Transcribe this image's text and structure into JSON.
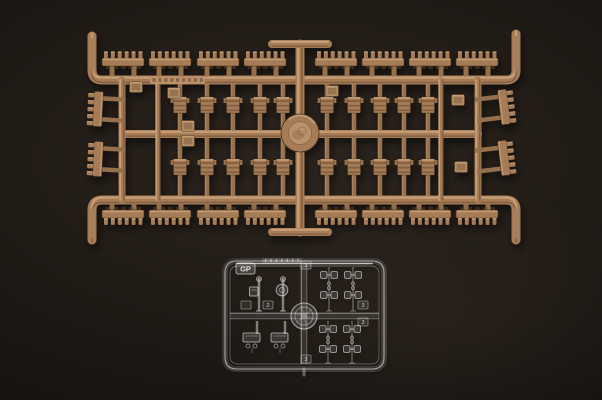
{
  "meta": {
    "description": "Photograph of two injection-molded model kit sprues on a black background: a large tan sprue of tank track links and small parts, and a small clear sprue of periscopes and lenses marked GP"
  },
  "background": {
    "center": "#2b241e",
    "mid": "#211b16",
    "edge": "#0c0a09"
  },
  "tan_sprue": {
    "label": "tan track-link sprue",
    "colors": {
      "base": "#a67c57",
      "base2": "#94704e",
      "light": "#cba57b",
      "dark": "#5e4029",
      "line": "#46301f",
      "tag": "#b08a61",
      "strip": "#bb9169",
      "hub_in": "#b9916b"
    },
    "top_rail": {
      "x1": 96,
      "x2": 512,
      "y": 80,
      "hook_y": 36,
      "w": 9
    },
    "bottom_rail": {
      "x1": 96,
      "x2": 512,
      "y": 200,
      "hook_y": 240,
      "w": 9
    },
    "mid_rail": {
      "x1": 124,
      "x2": 478,
      "y": 134,
      "w": 8
    },
    "v_rails": [
      {
        "x": 122,
        "y1": 80,
        "y2": 200,
        "w": 7
      },
      {
        "x": 158,
        "y1": 80,
        "y2": 200,
        "w": 5
      },
      {
        "x": 300,
        "y1": 44,
        "y2": 232,
        "w": 9
      },
      {
        "x": 441,
        "y1": 80,
        "y2": 200,
        "w": 5
      },
      {
        "x": 478,
        "y1": 80,
        "y2": 200,
        "w": 7
      }
    ],
    "t_bars": [
      {
        "x1": 272,
        "x2": 328,
        "y": 44,
        "w": 8
      },
      {
        "x1": 272,
        "x2": 328,
        "y": 232,
        "w": 8
      }
    ],
    "hub": {
      "cx": 300,
      "cy": 133,
      "r": 19
    },
    "text_strip": {
      "x": 150,
      "y": 76,
      "w": 55,
      "h": 8
    },
    "track_row_top": {
      "y": 62,
      "xs": [
        123,
        170,
        218,
        265,
        336,
        383,
        430,
        477
      ],
      "teeth": 6
    },
    "track_row_bottom": {
      "y": 214,
      "xs": [
        123,
        170,
        218,
        265,
        336,
        383,
        430,
        477
      ],
      "teeth": 6
    },
    "pin_rows": [
      {
        "y1": 84.5,
        "y2": 130.5,
        "cy": 105,
        "xs": [
          180,
          207,
          233,
          260,
          283,
          327,
          354,
          380,
          404,
          428
        ]
      },
      {
        "y1": 137.5,
        "y2": 195.5,
        "cy": 167,
        "xs": [
          180,
          207,
          233,
          260,
          283,
          327,
          354,
          380,
          404,
          428
        ]
      }
    ],
    "side_left": {
      "rail_x": 122,
      "cx": 98,
      "ys": [
        109,
        159
      ],
      "tilt": 3
    },
    "side_right": {
      "rail_x": 478,
      "cx": 504,
      "ys": [
        107,
        158
      ],
      "tilt": -7
    },
    "tags": [
      {
        "x": 136,
        "y": 87
      },
      {
        "x": 174,
        "y": 93
      },
      {
        "x": 188,
        "y": 126
      },
      {
        "x": 188,
        "y": 141
      },
      {
        "x": 332,
        "y": 91
      },
      {
        "x": 458,
        "y": 100
      },
      {
        "x": 461,
        "y": 167
      }
    ]
  },
  "clear_sprue": {
    "label": "clear parts sprue",
    "stroke": "rgba(255,255,255,0.55)",
    "stroke_dim": "rgba(255,255,255,0.30)",
    "fill": "rgba(222,230,238,0.10)",
    "frame": {
      "x": 225,
      "y": 261,
      "w": 159,
      "h": 108,
      "r": 12
    },
    "mid_h_y": 316,
    "mid_v_x": 304,
    "bottom_stub": {
      "x": 304,
      "y1": 369,
      "y2": 375
    },
    "hub": {
      "cx": 304,
      "cy": 316,
      "r": 13
    },
    "gp_tag": {
      "x": 236,
      "y": 263,
      "w": 19,
      "h": 11,
      "label": "GP"
    },
    "text_strip": {
      "x": 262,
      "y": 258,
      "w": 40,
      "h": 5
    },
    "tags": [
      {
        "x": 306,
        "y": 265,
        "label": "3"
      },
      {
        "x": 246,
        "y": 305,
        "label": ""
      },
      {
        "x": 268,
        "y": 305,
        "label": "2"
      },
      {
        "x": 363,
        "y": 305,
        "label": "3"
      },
      {
        "x": 363,
        "y": 322,
        "label": "3"
      },
      {
        "x": 306,
        "y": 359,
        "label": "3"
      }
    ],
    "periscopes_top": [
      {
        "x": 259,
        "head": "box"
      },
      {
        "x": 283,
        "head": "round"
      }
    ],
    "periscopes_bottom": [
      {
        "x": 251
      },
      {
        "x": 279
      }
    ],
    "spool_columns": [
      {
        "x": 329,
        "y1": 267,
        "y2": 311
      },
      {
        "x": 353,
        "y1": 267,
        "y2": 311
      },
      {
        "x": 328,
        "y1": 321,
        "y2": 363
      },
      {
        "x": 352,
        "y1": 321,
        "y2": 363
      }
    ]
  }
}
